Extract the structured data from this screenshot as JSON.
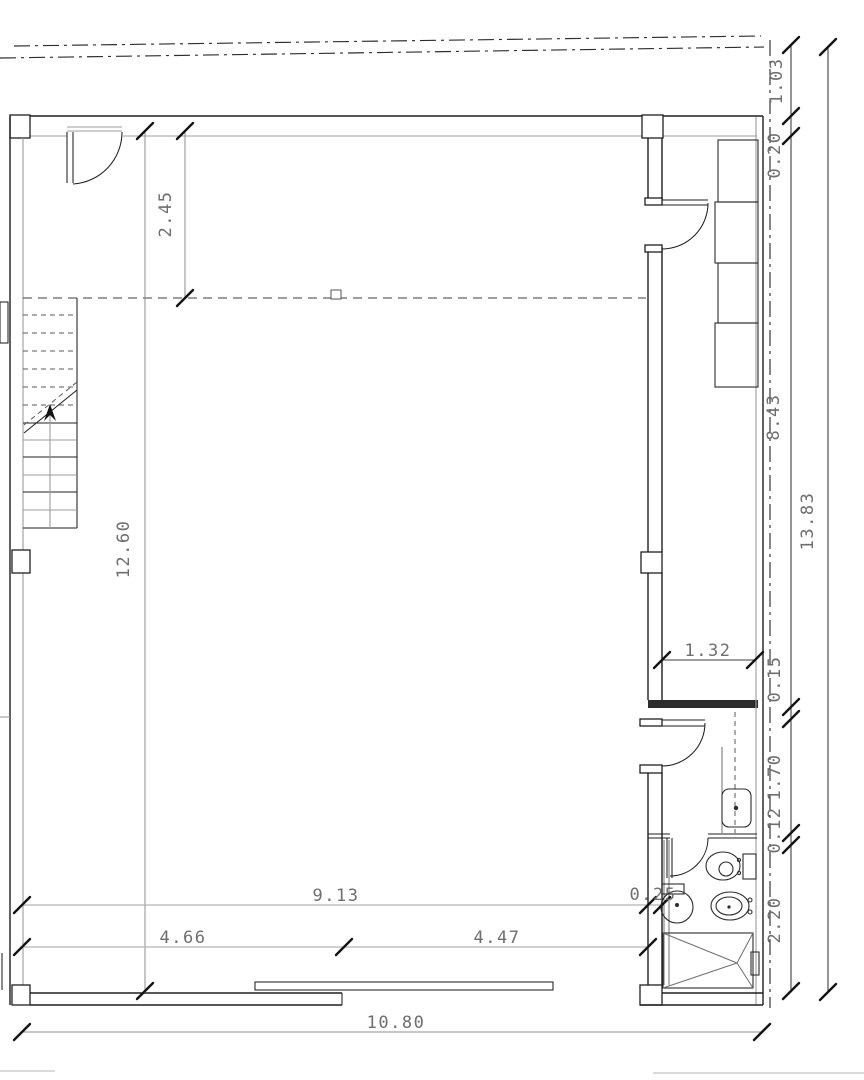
{
  "drawing": {
    "kind": "architectural floor plan, ground floor commercial space with staircase and WC",
    "colors": {
      "background": "#ffffff",
      "walls": "#1f1f1f",
      "dimension_text": "#6e6e6e"
    }
  },
  "dimensions": {
    "room_depth_top": "2.45",
    "interior_height_left": "12.60",
    "setback_top_right": "1.03",
    "wall_top_right": "0.20",
    "right_side_upper": "8.43",
    "right_side_total": "13.83",
    "bathroom_width": "1.32",
    "partition_upper": "0.15",
    "bathroom_corridor_depth": "1.70",
    "partition_lower": "0.12",
    "wc_room_depth": "2.20",
    "interior_width_bottom": "9.13",
    "wall_right_bottom": "0.25",
    "bottom_span_left": "4.66",
    "bottom_span_right": "4.47",
    "bottom_total_width": "10.80"
  }
}
